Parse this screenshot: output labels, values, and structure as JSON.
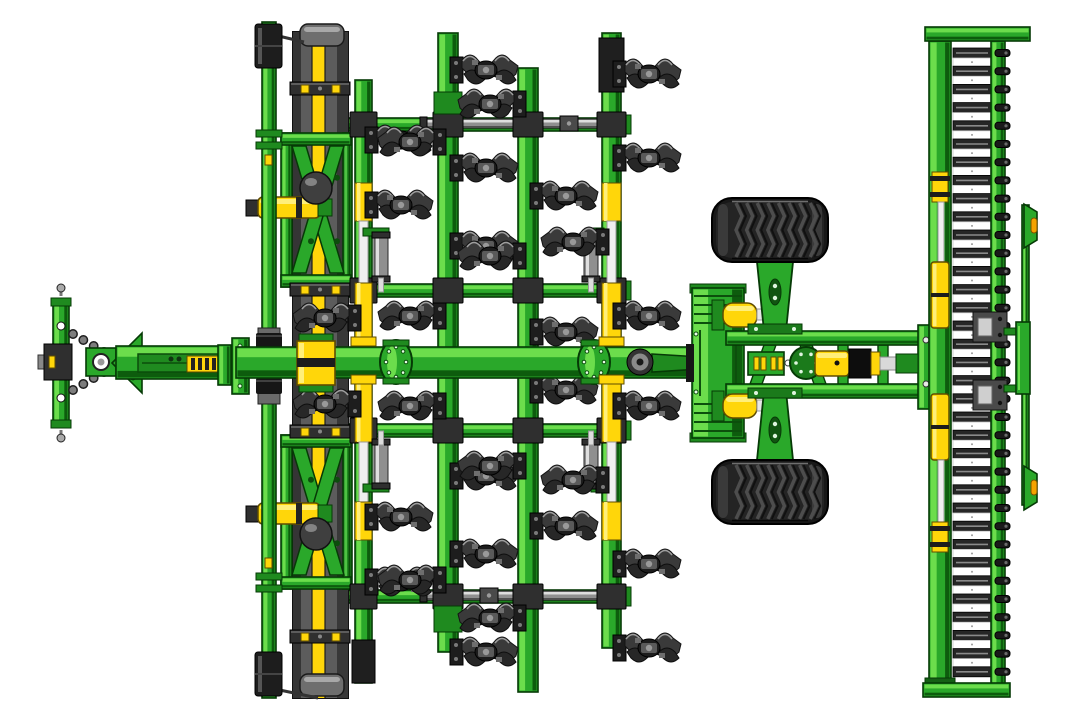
{
  "meta": {
    "description": "Top view technical CAD illustration of a green and yellow trailed seedbed cultivator: drawbar hitch with chains at left, front levelling board with yellow stripe, four toolbars carrying rows of dark spring tines, transport wheels on a lattice frame, and a rear bar roller with scraper bar at right."
  },
  "colors": {
    "background": "#ffffff",
    "green": {
      "base": "#2aa82a",
      "hi": "#6cdd4c",
      "lo": "#0d5c0d",
      "out": "#063a06"
    },
    "green2": {
      "base": "#1f8a1f",
      "hi": "#4fc144",
      "lo": "#0a4a0a",
      "out": "#063a06"
    },
    "yellow": {
      "base": "#ffd60a",
      "hi": "#ffef7a",
      "lo": "#c7a100",
      "out": "#5f4c00"
    },
    "steel": {
      "base": "#8f8f8f",
      "hi": "#dedede",
      "lo": "#4f4f4f",
      "out": "#2a2a2a"
    },
    "dark": "#2f2f2f",
    "dark2": "#1d1d1d",
    "dark3": "#4a4a4a",
    "grey_hi": "#9b9b9b",
    "tire": "#181818",
    "tread": "#4d4d4d",
    "tread_hi": "#6f6f6f",
    "white": "#ffffff",
    "orange": "#f5a300",
    "sphere": "#3f3f3f"
  },
  "machine": {
    "crossbar_h": 13,
    "crossbars": [
      {
        "x": 345,
        "y": 118,
        "w": 283
      },
      {
        "x": 345,
        "y": 284,
        "w": 283
      },
      {
        "x": 345,
        "y": 424,
        "w": 283
      },
      {
        "x": 345,
        "y": 590,
        "w": 283
      }
    ],
    "adjuster_tubes": [
      {
        "x": 424,
        "y": 119,
        "w": 178,
        "coupler": 560
      },
      {
        "x": 424,
        "y": 591,
        "w": 178,
        "coupler": 480
      }
    ],
    "leveling_board": {
      "x": 293,
      "w": 55,
      "y": 32,
      "h": 666,
      "stripes": [
        [
          0,
          8,
          "#353535"
        ],
        [
          8,
          11,
          "#5c5c5c"
        ],
        [
          19,
          13,
          "YELLOW"
        ],
        [
          32,
          12,
          "#5c5c5c"
        ],
        [
          44,
          11,
          "#383838"
        ]
      ],
      "caps": [
        [
          300,
          24,
          44,
          22
        ],
        [
          300,
          674,
          44,
          22
        ]
      ],
      "clamps": [
        82,
        283,
        425,
        630
      ]
    },
    "board_frames": [
      {
        "y": 133,
        "h": 154,
        "link_y": 197,
        "sphere_cy": 188
      },
      {
        "y": 435,
        "h": 154,
        "link_y": 503,
        "sphere_cy": 534
      }
    ],
    "front_tube": {
      "x": 262,
      "w": 14,
      "y1": 22,
      "y2": 698,
      "caps": [
        [
          255,
          24,
          27,
          44
        ],
        [
          255,
          652,
          27,
          44
        ]
      ],
      "grey_section": [
        258,
        328,
        22,
        76
      ],
      "rings": [
        333,
        378
      ],
      "collars": [
        130,
        573
      ],
      "yellow_marks": [
        155,
        558
      ],
      "diag_links": [
        [
          270,
          34,
          304,
          42
        ],
        [
          270,
          688,
          318,
          698
        ]
      ]
    },
    "toolbars": [
      {
        "x": 355,
        "w": 17,
        "y1": 80,
        "y2": 683,
        "sleeve": [
          640,
          43
        ],
        "cyl": true
      },
      {
        "x": 438,
        "w": 20,
        "y1": 33,
        "y2": 652,
        "end_clamps": [
          [
            92,
            22
          ],
          [
            606,
            26
          ]
        ]
      },
      {
        "x": 518,
        "w": 20,
        "y1": 68,
        "y2": 692
      },
      {
        "x": 602,
        "w": 19,
        "y1": 33,
        "y2": 648,
        "sleeve": [
          38,
          54
        ],
        "cyl": true
      }
    ],
    "toolbar_cyl": {
      "seg1": [
        183,
        38
      ],
      "rod1": [
        221,
        62
      ],
      "seg2": [
        283,
        62
      ],
      "seg3": [
        382,
        60
      ],
      "rod2": [
        442,
        60
      ],
      "seg4": [
        502,
        38
      ]
    },
    "dampers": [
      {
        "x": 374,
        "body_y": 236,
        "arm_y": 228,
        "rod_y": 278,
        "arm_x": 363
      },
      {
        "x": 584,
        "body_y": 236,
        "arm_y": 228,
        "rod_y": 278,
        "arm_x": 596
      },
      {
        "x": 374,
        "body_y": 443,
        "arm_y": 484,
        "rod_y": 431,
        "arm_x": 363
      },
      {
        "x": 584,
        "body_y": 443,
        "arm_y": 484,
        "rod_y": 431,
        "arm_x": 596
      }
    ],
    "tines": [
      {
        "x": 363,
        "y": 140,
        "d": 1
      },
      {
        "x": 363,
        "y": 205,
        "d": 1
      },
      {
        "x": 363,
        "y": 318,
        "d": -1
      },
      {
        "x": 363,
        "y": 582,
        "d": 1
      },
      {
        "x": 363,
        "y": 517,
        "d": 1
      },
      {
        "x": 363,
        "y": 404,
        "d": -1
      },
      {
        "x": 448,
        "y": 70,
        "d": 1
      },
      {
        "x": 448,
        "y": 142,
        "d": -1
      },
      {
        "x": 448,
        "y": 168,
        "d": 1
      },
      {
        "x": 448,
        "y": 246,
        "d": 1
      },
      {
        "x": 448,
        "y": 316,
        "d": -1
      },
      {
        "x": 448,
        "y": 652,
        "d": 1
      },
      {
        "x": 448,
        "y": 580,
        "d": -1
      },
      {
        "x": 448,
        "y": 554,
        "d": 1
      },
      {
        "x": 448,
        "y": 476,
        "d": 1
      },
      {
        "x": 448,
        "y": 406,
        "d": -1
      },
      {
        "x": 528,
        "y": 104,
        "d": -1
      },
      {
        "x": 528,
        "y": 196,
        "d": 1
      },
      {
        "x": 528,
        "y": 256,
        "d": -1
      },
      {
        "x": 528,
        "y": 332,
        "d": 1
      },
      {
        "x": 528,
        "y": 618,
        "d": -1
      },
      {
        "x": 528,
        "y": 526,
        "d": 1
      },
      {
        "x": 528,
        "y": 466,
        "d": -1
      },
      {
        "x": 528,
        "y": 390,
        "d": 1
      },
      {
        "x": 611,
        "y": 74,
        "d": 1
      },
      {
        "x": 611,
        "y": 158,
        "d": 1
      },
      {
        "x": 611,
        "y": 242,
        "d": -1
      },
      {
        "x": 611,
        "y": 316,
        "d": 1
      },
      {
        "x": 611,
        "y": 648,
        "d": 1
      },
      {
        "x": 611,
        "y": 564,
        "d": 1
      },
      {
        "x": 611,
        "y": 480,
        "d": -1
      },
      {
        "x": 611,
        "y": 406,
        "d": 1
      }
    ],
    "beam": {
      "y": 347,
      "h": 31,
      "x2": 702,
      "hitch_bar": {
        "x": 53,
        "y": 300,
        "w": 16,
        "h": 126,
        "holes": [
          326,
          398
        ]
      },
      "pins": [
        [
          61,
          288
        ],
        [
          61,
          438
        ]
      ],
      "hitch_block": [
        44,
        344,
        28,
        36
      ],
      "chains": [
        [
          73,
          334,
          104,
          352
        ],
        [
          73,
          390,
          104,
          372
        ]
      ],
      "clevis": [
        86,
        348,
        30,
        28
      ],
      "clevis_hole": [
        101,
        362
      ],
      "triangle": [
        [
          112,
          363
        ],
        [
          142,
          333
        ],
        [
          142,
          393
        ]
      ],
      "seg1": [
        116,
        346,
        120,
        33
      ],
      "inner_tube": [
        138,
        354,
        80,
        18
      ],
      "hash1": [
        187,
        356,
        31,
        16
      ],
      "flanges": [
        [
          218,
          345,
          13,
          40
        ],
        [
          232,
          338,
          17,
          56
        ]
      ],
      "hinges": [
        396,
        594
      ],
      "hub": [
        640,
        362
      ],
      "arm": [
        [
          652,
          354
        ],
        [
          700,
          357
        ],
        [
          700,
          369
        ],
        [
          652,
          372
        ]
      ],
      "board_block": [
        297,
        341,
        38,
        44
      ],
      "yellow_clamps": [
        [
          351,
          337
        ],
        [
          351,
          375
        ],
        [
          599,
          337
        ],
        [
          599,
          375
        ]
      ]
    },
    "right_frame": {
      "tower": [
        692,
        288,
        52,
        150
      ],
      "black_link": [
        686,
        344,
        8,
        38
      ],
      "rails": [
        [
          726,
          331,
          198,
          14
        ],
        [
          726,
          384,
          198,
          14
        ]
      ],
      "end_post": [
        918,
        325,
        16,
        84
      ],
      "lattice_diag": [
        [
          750,
          384,
          764,
          345,
          776,
          345,
          762,
          384
        ],
        [
          800,
          345,
          814,
          384,
          826,
          384,
          812,
          345
        ]
      ],
      "lattice_vert": [
        [
          838,
          345,
          10,
          40
        ],
        [
          878,
          345,
          10,
          40
        ]
      ],
      "hash_block": [
        748,
        352,
        36,
        23
      ],
      "cyl_flange": [
        806,
        363,
        16
      ],
      "cyl_body": [
        815,
        351,
        34,
        25
      ],
      "cyl_black": [
        849,
        349,
        22,
        29
      ],
      "cyl_collar": [
        871,
        352,
        9,
        23
      ],
      "cyl_rod": [
        880,
        357,
        16,
        13
      ],
      "cyl_clevis": [
        896,
        354,
        22,
        19
      ],
      "wheel_cyls": [
        {
          "base": [
            712,
            300,
            12,
            30
          ],
          "body": [
            723,
            303,
            34,
            24
          ],
          "rod": [
            757,
            309,
            14,
            11
          ],
          "tip": [
            771,
            305,
            12,
            18
          ]
        },
        {
          "base": [
            712,
            391,
            12,
            30
          ],
          "body": [
            723,
            394,
            34,
            24
          ],
          "rod": [
            757,
            400,
            14,
            11
          ],
          "tip": [
            771,
            396,
            12,
            18
          ]
        }
      ],
      "wheel_arms": [
        {
          "poly": [
            [
              757,
              262
            ],
            [
              793,
              262
            ],
            [
              786,
              331
            ],
            [
              764,
              331
            ]
          ],
          "plate": [
            748,
            324,
            54,
            10
          ],
          "slot": [
            775,
            292
          ]
        },
        {
          "poly": [
            [
              757,
              460
            ],
            [
              793,
              460
            ],
            [
              786,
              391
            ],
            [
              764,
              391
            ]
          ],
          "plate": [
            748,
            388,
            54,
            10
          ],
          "slot": [
            775,
            430
          ]
        }
      ]
    },
    "wheels": [
      {
        "x": 712,
        "y": 198,
        "w": 116,
        "h": 64,
        "treads": 8
      },
      {
        "x": 712,
        "y": 460,
        "w": 116,
        "h": 64,
        "treads": 8
      }
    ],
    "roller": {
      "caps": [
        [
          925,
          27,
          105,
          14
        ],
        [
          923,
          683,
          87,
          14
        ]
      ],
      "frame_bar": [
        929,
        41,
        22,
        644
      ],
      "rungs": {
        "x": 953,
        "w": 38,
        "y0": 48,
        "count": 35,
        "pitch": 18.2,
        "h": 10
      },
      "strip": [
        991,
        41,
        14,
        644
      ],
      "knob_x": 995,
      "cyl": {
        "fit1": [
          932,
          172,
          16,
          30
        ],
        "rod1": [
          938,
          202,
          6,
          60
        ],
        "body1": [
          931,
          262,
          18,
          66
        ],
        "body2": [
          931,
          394,
          18,
          66
        ],
        "rod2": [
          938,
          460,
          6,
          62
        ],
        "fit2": [
          932,
          522,
          16,
          30
        ]
      },
      "bearings": [
        [
          973,
          312,
          34,
          30
        ],
        [
          973,
          380,
          34,
          30
        ]
      ]
    },
    "scraper": {
      "bar": [
        1022,
        205,
        7,
        300
      ],
      "arms": [
        [
          1004,
          328,
          18,
          7
        ],
        [
          1004,
          385,
          18,
          7
        ]
      ],
      "center": [
        1016,
        322,
        14,
        72
      ],
      "wings": [
        {
          "poly": [
            [
              1024,
              204
            ],
            [
              1037,
              212
            ],
            [
              1037,
              240
            ],
            [
              1024,
              248
            ]
          ],
          "dot": [
            1031,
            218
          ]
        },
        {
          "poly": [
            [
              1024,
              466
            ],
            [
              1037,
              474
            ],
            [
              1037,
              502
            ],
            [
              1024,
              510
            ]
          ],
          "dot": [
            1031,
            480
          ]
        }
      ]
    }
  }
}
